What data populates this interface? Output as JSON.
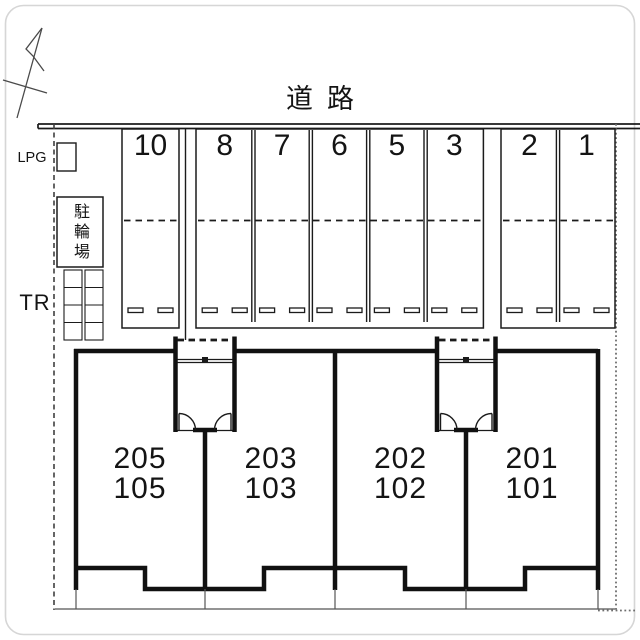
{
  "road": {
    "label": "道路"
  },
  "compass": {
    "icon": "north-arrow-icon"
  },
  "parking": {
    "spots": [
      {
        "number": "10"
      },
      {
        "number": "8"
      },
      {
        "number": "7"
      },
      {
        "number": "6"
      },
      {
        "number": "5"
      },
      {
        "number": "3"
      },
      {
        "number": "2"
      },
      {
        "number": "1"
      }
    ]
  },
  "facilities": {
    "lpg": "LPG",
    "bicycle_parking": "駐輪場",
    "trash": "TR"
  },
  "building": {
    "units": [
      {
        "upper": "205",
        "lower": "105"
      },
      {
        "upper": "203",
        "lower": "103"
      },
      {
        "upper": "202",
        "lower": "102"
      },
      {
        "upper": "201",
        "lower": "101"
      }
    ]
  },
  "colors": {
    "line": "#1b1b1b",
    "muted_line": "#555555",
    "frame": "#d6d6d6"
  }
}
